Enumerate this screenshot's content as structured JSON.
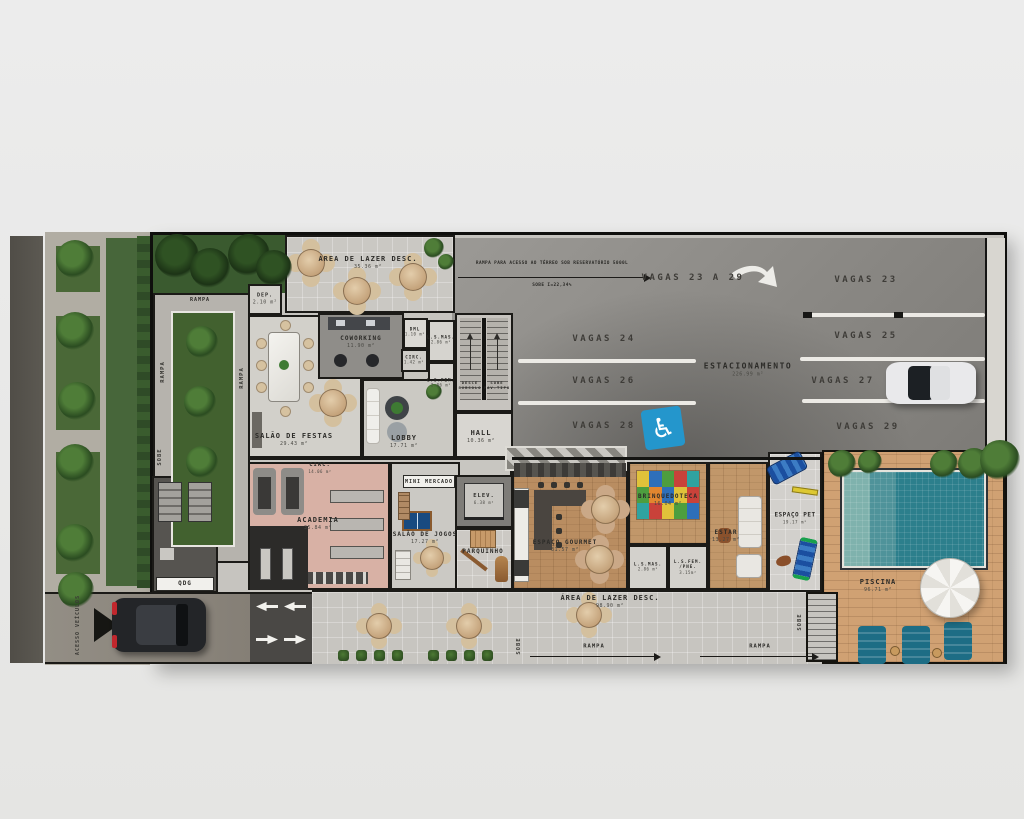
{
  "colors": {
    "asphalt_street": "#56534c",
    "parking_asphalt": "#8e8c88",
    "handicap_blue": "#2496cc",
    "pool_teal": "#2c7f8c",
    "wood_deck": "#d0a173",
    "grass": "#47663a",
    "academia_floor": "#d8b1a5"
  },
  "plan": {
    "site": {
      "acesso_veiculos": "ACESSO VEÍCULOS",
      "rampa": "RAMPA",
      "sobe": "SOBE"
    },
    "rooms": {
      "area_lazer_top": {
        "label": "ÁREA DE LAZER DESC.",
        "area": "35.36 m²"
      },
      "dep": {
        "label": "DEP.",
        "area": "2.10 m²"
      },
      "coworking": {
        "label": "COWORKING",
        "area": "11.90 m²"
      },
      "dml": {
        "label": "DML",
        "area": "1.10 m²"
      },
      "ls_mas_top": {
        "label": "L.S.MAS.",
        "area": "2.86 m²"
      },
      "circ_small": {
        "label": "CIRC.",
        "area": "1.42 m²"
      },
      "ls_fem_top": {
        "label": "L.S.FEM.",
        "area": "2.86 m²"
      },
      "salao_festas": {
        "label": "SALÃO DE FESTAS",
        "area": "29.43 m²"
      },
      "lobby": {
        "label": "LOBBY",
        "area": "17.71 m²"
      },
      "hall": {
        "label": "HALL",
        "area": "10.36 m²"
      },
      "circ_main": {
        "label": "CIRC.",
        "area": "14.06 m²"
      },
      "qdg": {
        "label": "QDG"
      },
      "academia": {
        "label": "ACADEMIA",
        "area": "35.84 m²"
      },
      "salao_jogos": {
        "label": "SALÃO DE JOGOS",
        "area": "17.27 m²"
      },
      "mini_mercado": {
        "label": "MINI MERCADO"
      },
      "elev": {
        "label": "ELEV.",
        "area": "6.38 m²"
      },
      "parquinho": {
        "label": "PARQUINHO"
      },
      "espaco_gourmet": {
        "label": "ESPAÇO GOURMET",
        "area": "31.57 m²"
      },
      "brinquedoteca": {
        "label": "BRINQUEDOTECA",
        "area": "16.04 m²"
      },
      "estar": {
        "label": "ESTAR",
        "area": "13.27 m²"
      },
      "ls_mas_bottom": {
        "label": "L.S.MAS.",
        "area": "2.86 m²"
      },
      "ls_fem_pne": {
        "label": "L.S.FEM.",
        "line2": "/PNE.",
        "area": "3.15m²"
      },
      "espaco_pet": {
        "label": "ESPAÇO PET",
        "area": "19.17 m²"
      },
      "piscina": {
        "label": "PISCINA",
        "area": "96.71 m²"
      },
      "area_lazer_bottom": {
        "label": "ÁREA DE LAZER DESC.",
        "area": "98.90 m²"
      }
    },
    "stairs": {
      "down_line1": "DESCE",
      "down_line2": "SUBSOLO",
      "up_line1": "SOBE",
      "up_line2": "PAV.TIPO"
    },
    "parking": {
      "label": "ESTACIONAMENTO",
      "area": "226.99 m²",
      "ramp_note": "RAMPA PARA ACESSO AO TÉRREO SOB RESERVATÓRIO 5000L",
      "ramp_slope": "SOBE I=22,34%",
      "vagas_range": "VAGAS 23 A 29",
      "stalls_left": [
        "VAGAS 24",
        "VAGAS 26",
        "VAGAS 28"
      ],
      "stalls_right": [
        "VAGAS 23",
        "VAGAS 25",
        "VAGAS 27",
        "VAGAS 29"
      ]
    }
  }
}
